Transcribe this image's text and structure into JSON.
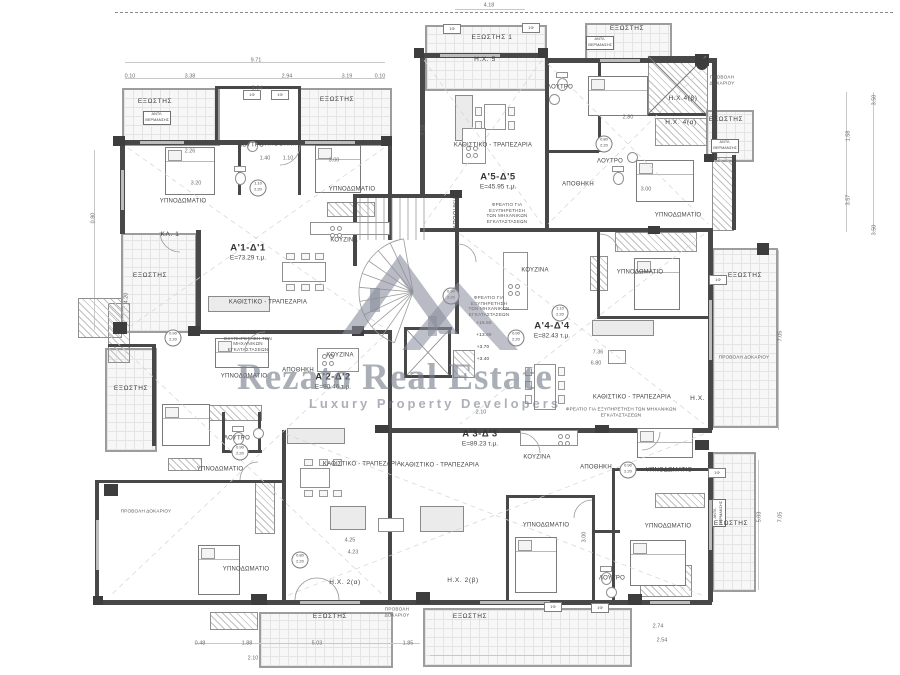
{
  "watermark": {
    "brand": "Rezato Real Estate",
    "tagline": "Luxury Property Developers",
    "color": "#7a8090"
  },
  "apartments": [
    {
      "id": "Α'1-Δ'1",
      "area": "Ε=73.29 τ.μ.",
      "x": 248,
      "y": 252
    },
    {
      "id": "Α'2-Δ'2",
      "area": "Ε=90.46 τ.μ.",
      "x": 333,
      "y": 381
    },
    {
      "id": "Α'3-Δ'3",
      "area": "Ε=89.23 τ.μ.",
      "x": 480,
      "y": 438
    },
    {
      "id": "Α'4-Δ'4",
      "area": "Ε=82.43 τ.μ.",
      "x": 552,
      "y": 330
    },
    {
      "id": "Α'5-Δ'5",
      "area": "Ε=45.95 τ.μ.",
      "x": 498,
      "y": 181
    }
  ],
  "rooms": [
    {
      "t": "ΥΠΝΟΔΩΜΑΤΙΟ",
      "x": 183,
      "y": 202
    },
    {
      "t": "ΥΠΝΟΔΩΜΑΤΙΟ",
      "x": 352,
      "y": 190
    },
    {
      "t": "ΥΠΝΟΔΩΜΑΤΙΟ",
      "x": 640,
      "y": 273
    },
    {
      "t": "ΥΠΝΟΔΩΜΑΤΙΟ",
      "x": 678,
      "y": 216
    },
    {
      "t": "ΥΠΝΟΔΩΜΑΤΙΟ",
      "x": 244,
      "y": 377
    },
    {
      "t": "ΥΠΝΟΔΩΜΑΤΙΟ",
      "x": 220,
      "y": 470
    },
    {
      "t": "ΥΠΝΟΔΩΜΑΤΙΟ",
      "x": 246,
      "y": 570
    },
    {
      "t": "ΥΠΝΟΔΩΜΑΤΙΟ",
      "x": 546,
      "y": 526
    },
    {
      "t": "ΥΠΝΟΔΩΜΑΤΙΟ",
      "x": 668,
      "y": 527
    },
    {
      "t": "ΥΠΝΟΔΩΜΑΤΙΟ",
      "x": 669,
      "y": 471
    },
    {
      "t": "ΛΟΥΤΡΟ",
      "x": 251,
      "y": 146
    },
    {
      "t": "ΛΟΥΤΡΟ",
      "x": 560,
      "y": 88
    },
    {
      "t": "ΛΟΥΤΡΟ",
      "x": 610,
      "y": 162
    },
    {
      "t": "ΛΟΥΤΡΟ",
      "x": 237,
      "y": 439
    },
    {
      "t": "ΛΟΥΤΡΟ",
      "x": 612,
      "y": 579
    },
    {
      "t": "ΑΠΟΘΗΚΗ",
      "x": 281,
      "y": 145
    },
    {
      "t": "ΑΠΟΘΗΚΗ",
      "x": 298,
      "y": 371
    },
    {
      "t": "ΑΠΟΘΗΚΗ",
      "x": 578,
      "y": 185
    },
    {
      "t": "ΑΠΟΘΗΚΗ",
      "x": 596,
      "y": 468
    },
    {
      "t": "ΑΠΟΘΗΚΗ",
      "x": 457,
      "y": 213,
      "rot": 1
    },
    {
      "t": "ΚΟΥΖΙΝΑ",
      "x": 344,
      "y": 241
    },
    {
      "t": "ΚΟΥΖΙΝΑ",
      "x": 340,
      "y": 356
    },
    {
      "t": "ΚΟΥΖΙΝΑ",
      "x": 537,
      "y": 458
    },
    {
      "t": "ΚΟΥΖΙΝΑ",
      "x": 535,
      "y": 271
    },
    {
      "t": "ΚΑΘΙΣΤΙΚΟ - ΤΡΑΠΕΖΑΡΙΑ",
      "x": 268,
      "y": 303
    },
    {
      "t": "ΚΑΘΙΣΤΙΚΟ - ΤΡΑΠΕΖΑΡΙΑ",
      "x": 493,
      "y": 146
    },
    {
      "t": "ΚΑΘΙΣΤΙΚΟ - ΤΡΑΠΕΖΑΡΙΑ",
      "x": 362,
      "y": 465
    },
    {
      "t": "ΚΑΘΙΣΤΙΚΟ - ΤΡΑΠΕΖΑΡΙΑ",
      "x": 632,
      "y": 398
    },
    {
      "t": "ΚΑΘΙΣΤΙΚΟ - ΤΡΑΠΕΖΑΡΙΑ",
      "x": 440,
      "y": 466
    }
  ],
  "balconies": [
    {
      "t": "ΕΞΩΣΤΗΣ",
      "a": "Ε=4.79 τ.μ.",
      "x": 155,
      "y": 106
    },
    {
      "t": "ΕΞΩΣΤΗΣ",
      "a": "Ε=4.37 τ.μ.",
      "x": 337,
      "y": 104
    },
    {
      "t": "ΕΞΩΣΤΗΣ 1",
      "a": "Ε=6.87 τ.μ.",
      "x": 492,
      "y": 42
    },
    {
      "t": "ΕΞΩΣΤΗΣ",
      "a": "Ε=4.04 τ.μ.",
      "x": 627,
      "y": 33
    },
    {
      "t": "ΕΞΩΣΤΗΣ",
      "a": "Ε=1.79 τ.μ.",
      "x": 726,
      "y": 124
    },
    {
      "t": "ΕΞΩΣΤΗΣ",
      "a": "Ε=17.31 τ.μ.",
      "x": 745,
      "y": 280
    },
    {
      "t": "ΕΞΩΣΤΗΣ",
      "a": "Ε=11.52 τ.μ.",
      "x": 150,
      "y": 280
    },
    {
      "t": "ΕΞΩΣΤΗΣ",
      "a": "Ε=10.03 τ.μ.",
      "x": 131,
      "y": 393
    },
    {
      "t": "ΕΞΩΣΤΗΣ",
      "a": "Ε=12.20 τ.μ.",
      "x": 330,
      "y": 621
    },
    {
      "t": "ΕΞΩΣΤΗΣ",
      "a": "Ε=19.70 τ.μ.",
      "x": 470,
      "y": 621
    },
    {
      "t": "ΕΞΩΣΤΗΣ",
      "a": "Ε=7.77 τ.μ.",
      "x": 731,
      "y": 528
    },
    {
      "t": "ΚΛ. 1",
      "a": "Ε=0.46 τ.μ.",
      "x": 170,
      "y": 239
    }
  ],
  "hx": [
    {
      "t": "Η.Χ. 5",
      "a": "Ε=2.19 τ.μ.",
      "x": 485,
      "y": 63
    },
    {
      "t": "Η.Χ.4(β)",
      "a": "Ε=2.62 τ.μ.",
      "x": 683,
      "y": 102
    },
    {
      "t": "Η.Χ. 4(α)",
      "a": "Ε=2.02 τ.μ.",
      "x": 681,
      "y": 126
    },
    {
      "t": "Η.Χ. 3",
      "a": "Ε=2.01 τ.μ.",
      "x": 701,
      "y": 402
    },
    {
      "t": "Η.Χ. 2(α)",
      "a": "Ε=9.24 τ.μ.",
      "x": 345,
      "y": 586
    },
    {
      "t": "Η.Χ. 2(β)",
      "a": "Ε=6.80 τ.μ.",
      "x": 463,
      "y": 584
    }
  ],
  "shaft_notes": [
    {
      "t": "ΦΡΕΑΤΙΟ ΓΙΑ ΕΞΥΠΗΡΕΤΗΣΗ ΤΩΝ ΜΗΧΑΝΙΚΩΝ ΕΓΚΑΤΑΣΤΑΣΕΩΝ",
      "x": 248,
      "y": 341,
      "w": 60
    },
    {
      "t": "ΦΡΕΑΤΙΟ ΓΙΑ ΕΞΥΠΗΡΕΤΗΣΗ ΤΩΝ ΜΗΧΑΝΙΚΩΝ ΕΓΚΑΤΑΣΤΑΣΕΩΝ",
      "x": 507,
      "y": 213,
      "w": 46
    },
    {
      "t": "ΦΡΕΑΤΙΟ ΓΙΑ ΕΞΥΠΗΡΕΤΗΣΗ ΤΩΝ ΜΗΧΑΝΙΚΩΝ ΕΓΚΑΤΑΣΤΑΣΕΩΝ",
      "x": 489,
      "y": 306,
      "w": 44
    },
    {
      "t": "ΦΡΕΑΤΙΟ ΓΙΑ ΕΞΥΠΗΡΕΤΗΣΗ ΤΩΝ ΜΗΧΑΝΙΚΩΝ ΕΓΚΑΤΑΣΤΑΣΕΩΝ",
      "x": 621,
      "y": 412,
      "w": 120
    }
  ],
  "beam_notes": [
    {
      "t": "ΠΡΟΒΟΛΗ ΔΟΚΑΡΙΟΥ",
      "x": 722,
      "y": 80,
      "w": 34
    },
    {
      "t": "ΠΡΟΒΟΛΗ ΔΟΚΑΡΙΟΥ",
      "x": 744,
      "y": 357,
      "w": 90
    },
    {
      "t": "ΠΡΟΒΟΛΗ ΔΟΚΑΡΙΟΥ",
      "x": 397,
      "y": 612,
      "w": 34
    },
    {
      "t": "ΠΡΟΒΟΛΗ ΔΟΚΑΡΙΟΥ",
      "x": 146,
      "y": 511,
      "w": 90
    }
  ],
  "pump_boxes": [
    {
      "t": "ΑΝΤΛ. ΘΕΡΜΑΝΣΗΣ",
      "x": 157,
      "y": 118,
      "rot": 0
    },
    {
      "t": "ΑΝΤΛ. ΘΕΡΜΑΝΣΗΣ",
      "x": 600,
      "y": 43,
      "rot": 0
    },
    {
      "t": "ΑΝΤΛ. ΘΕΡΜΑΝΣΗΣ",
      "x": 725,
      "y": 146,
      "rot": 0
    },
    {
      "t": "ΑΝΤΛ. ΘΕΡΜΑΝΣΗΣ",
      "x": 719,
      "y": 513,
      "rot": 1
    }
  ],
  "levels": [
    {
      "t": "+15.50",
      "x": 484,
      "y": 323
    },
    {
      "t": "+13.90",
      "x": 484,
      "y": 335
    },
    {
      "t": "+3.70",
      "x": 483,
      "y": 347
    },
    {
      "t": "+3.40",
      "x": 483,
      "y": 359
    }
  ],
  "dims": [
    [
      "9.71",
      256,
      61,
      0
    ],
    [
      "0.10",
      130,
      77,
      0
    ],
    [
      "3.38",
      190,
      77,
      0
    ],
    [
      "2.94",
      287,
      77,
      0
    ],
    [
      "3.19",
      347,
      77,
      0
    ],
    [
      "0.10",
      380,
      77,
      0
    ],
    [
      "3.04",
      257,
      89,
      0
    ],
    [
      "4.18",
      489,
      6,
      0
    ],
    [
      "3.50",
      875,
      100,
      1
    ],
    [
      "1.58",
      849,
      136,
      1
    ],
    [
      "3.57",
      849,
      200,
      1
    ],
    [
      "3.50",
      875,
      230,
      1
    ],
    [
      "7.05",
      781,
      336,
      1
    ],
    [
      "5.03",
      760,
      517,
      1
    ],
    [
      "7.05",
      781,
      517,
      1
    ],
    [
      "0.80",
      94,
      218,
      1
    ],
    [
      "4.20",
      127,
      298,
      1
    ],
    [
      "7.15",
      424,
      130,
      1
    ],
    [
      "0.48",
      200,
      644,
      0
    ],
    [
      "1.88",
      247,
      644,
      0
    ],
    [
      "2.10",
      253,
      659,
      0
    ],
    [
      "5.03",
      317,
      644,
      0
    ],
    [
      "1.85",
      408,
      644,
      0
    ],
    [
      "2.74",
      658,
      627,
      0
    ],
    [
      "2.54",
      662,
      641,
      0
    ],
    [
      "3.20",
      196,
      184,
      0
    ],
    [
      "2.26",
      190,
      152,
      0
    ],
    [
      "1.40",
      265,
      159,
      0
    ],
    [
      "1.10",
      288,
      159,
      0
    ],
    [
      "3.00",
      334,
      161,
      0
    ],
    [
      "2.80",
      628,
      118,
      0
    ],
    [
      "3.00",
      646,
      190,
      0
    ],
    [
      "7.36",
      598,
      353,
      0
    ],
    [
      "6.80",
      596,
      364,
      0
    ],
    [
      "4.25",
      350,
      541,
      0
    ],
    [
      "4.23",
      353,
      553,
      0
    ],
    [
      "2.10",
      481,
      413,
      0
    ],
    [
      "3.00",
      585,
      537,
      1
    ]
  ],
  "door_tags": [
    {
      "w": "1.10",
      "h": "2.20",
      "x": 258,
      "y": 188
    },
    {
      "w": "0.90",
      "h": "2.20",
      "x": 516,
      "y": 338
    },
    {
      "w": "0.90",
      "h": "2.20",
      "x": 173,
      "y": 338
    },
    {
      "w": "0.90",
      "h": "2.20",
      "x": 240,
      "y": 452
    },
    {
      "w": "0.80",
      "h": "2.20",
      "x": 300,
      "y": 560
    },
    {
      "w": "0.90",
      "h": "2.20",
      "x": 628,
      "y": 470
    },
    {
      "w": "1.10",
      "h": "2.20",
      "x": 560,
      "y": 313
    },
    {
      "w": "0.80",
      "h": "2.20",
      "x": 604,
      "y": 144
    },
    {
      "w": "0.90",
      "h": "2.20",
      "x": 451,
      "y": 296
    }
  ],
  "window_tags": [
    {
      "t": "1Φ 1.60/2.20",
      "x": 252,
      "y": 95
    },
    {
      "t": "1Φ 1.60/2.20",
      "x": 280,
      "y": 95
    },
    {
      "t": "1Φ 1.60/2.20",
      "x": 452,
      "y": 29
    },
    {
      "t": "1Φ 1.60/2.20",
      "x": 531,
      "y": 28
    },
    {
      "t": "1Φ 1.60/2.20",
      "x": 718,
      "y": 280
    },
    {
      "t": "1Φ 1.60/2.20",
      "x": 717,
      "y": 473
    },
    {
      "t": "1Φ 1.60/2.20",
      "x": 553,
      "y": 607
    },
    {
      "t": "1Φ 1.60/2.20",
      "x": 600,
      "y": 608
    }
  ]
}
